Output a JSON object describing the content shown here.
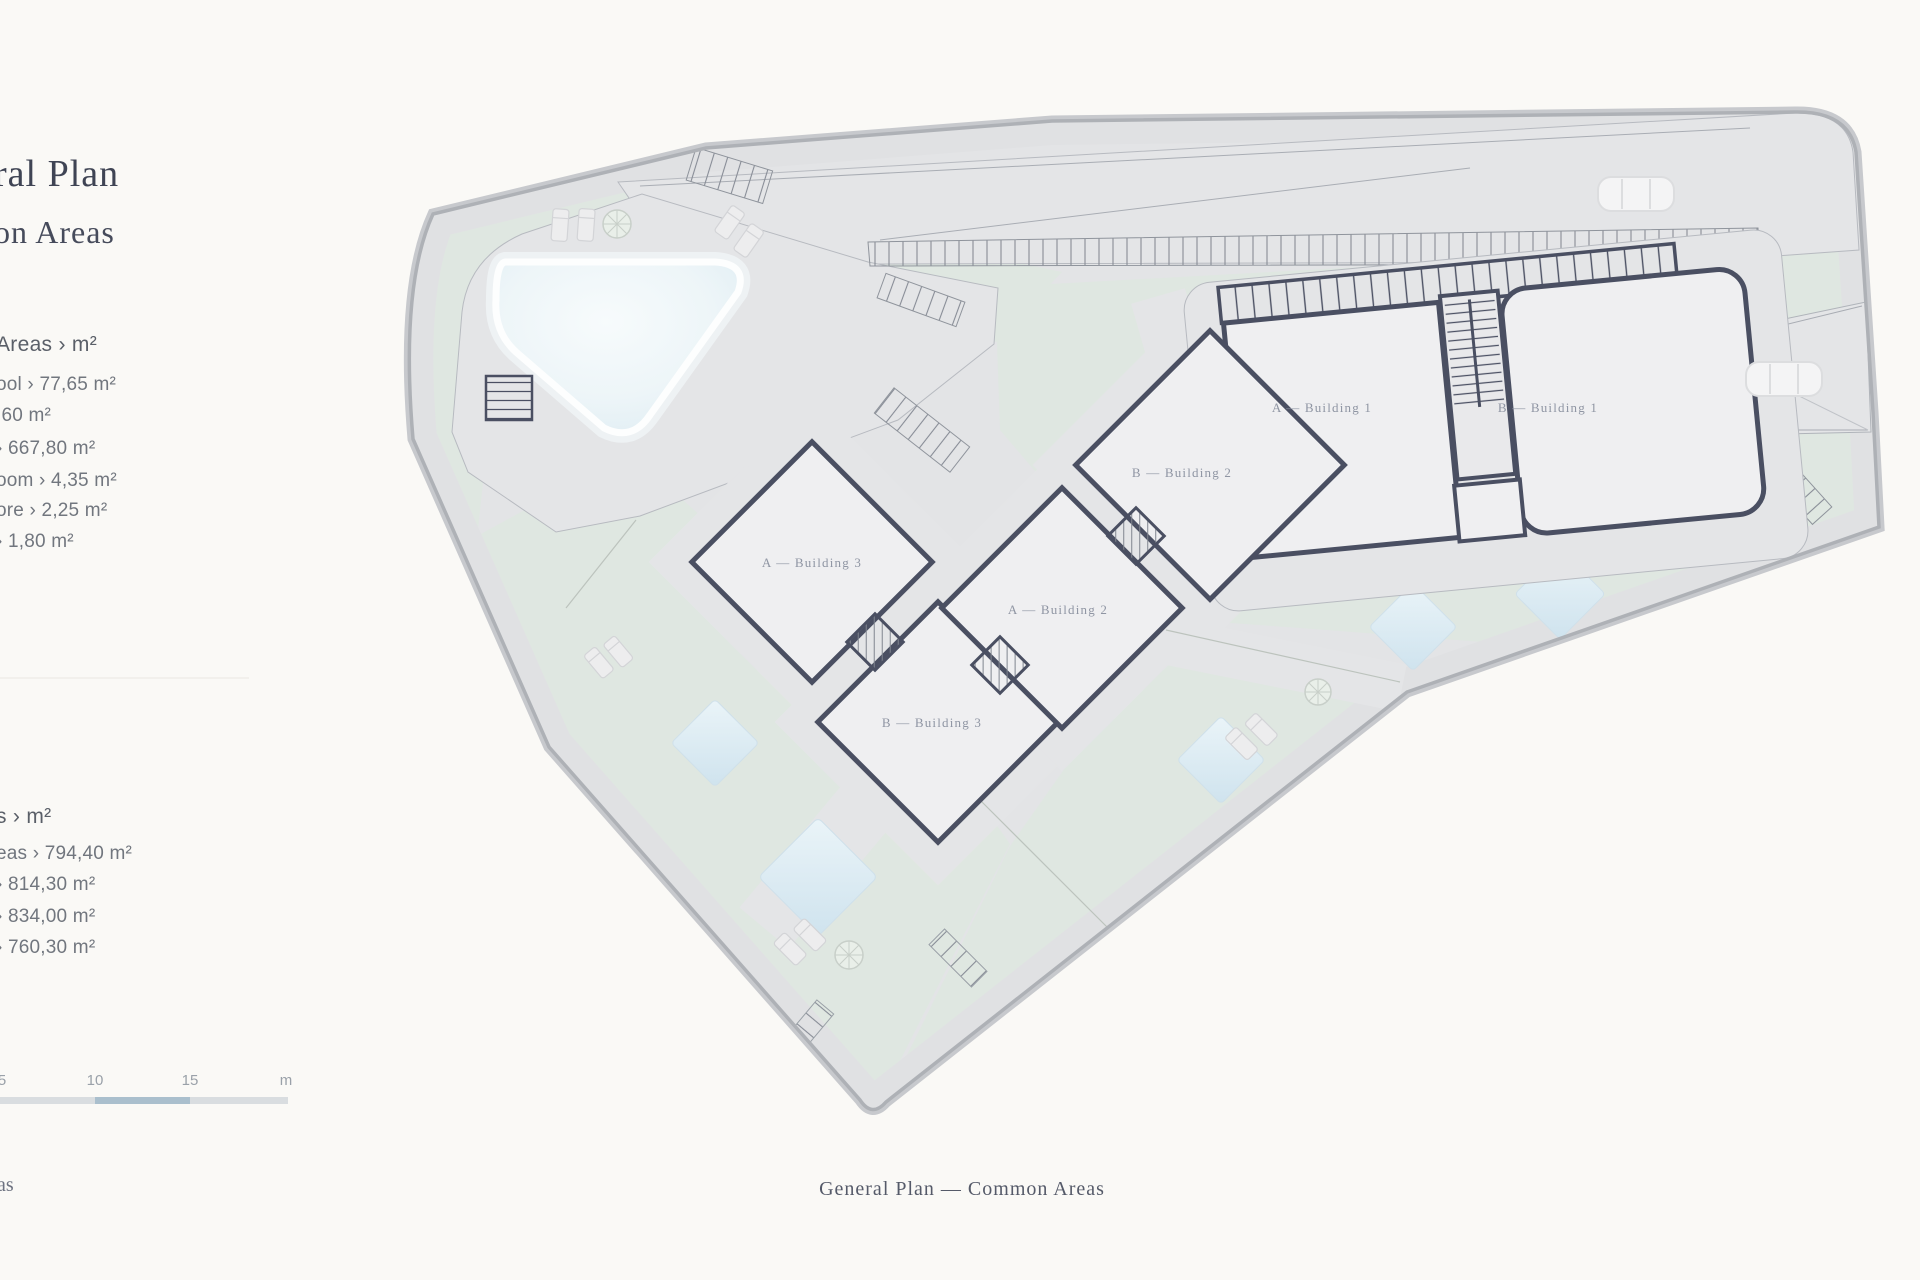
{
  "page": {
    "background": "#FAF9F6"
  },
  "sidebar": {
    "title_fragment_line1": "ral Plan",
    "title_fragment_line2": "on Areas",
    "section1": {
      "header_fragment": "Areas › m²",
      "items": [
        {
          "fragment": "ool › 77,65 m²"
        },
        {
          "fragment": ",60 m²"
        },
        {
          "fragment": "› 667,80 m²"
        },
        {
          "fragment": "oom › 4,35 m²"
        },
        {
          "fragment": "ore › 2,25 m²"
        },
        {
          "fragment": "› 1,80 m²"
        }
      ]
    },
    "section2": {
      "header_fragment": "s › m²",
      "items": [
        {
          "fragment": "eas › 794,40 m²"
        },
        {
          "fragment": "› 814,30 m²"
        },
        {
          "fragment": "› 834,00 m²"
        },
        {
          "fragment": "› 760,30 m²"
        }
      ]
    },
    "bottom_fragment": "as"
  },
  "scalebar": {
    "ticks": [
      "5",
      "10",
      "15",
      "m"
    ],
    "bar_color": "#D9DDE0",
    "accent_color": "#AABFCD"
  },
  "plan": {
    "buildings": [
      {
        "label": "A — Building 1"
      },
      {
        "label": "B — Building 1"
      },
      {
        "label": "B — Building 2"
      },
      {
        "label": "A — Building 2"
      },
      {
        "label": "A — Building 3"
      },
      {
        "label": "B — Building 3"
      }
    ],
    "colors": {
      "site_gray": "#E3E4E6",
      "green": "#DFE7E1",
      "building_fill": "#EFEFF1",
      "building_stroke": "#4A4F62",
      "boundary": "#B1B4B9",
      "pool": "#EAF4F8",
      "plunge_pool": "#D8E9F1"
    }
  },
  "caption": "General Plan — Common Areas"
}
